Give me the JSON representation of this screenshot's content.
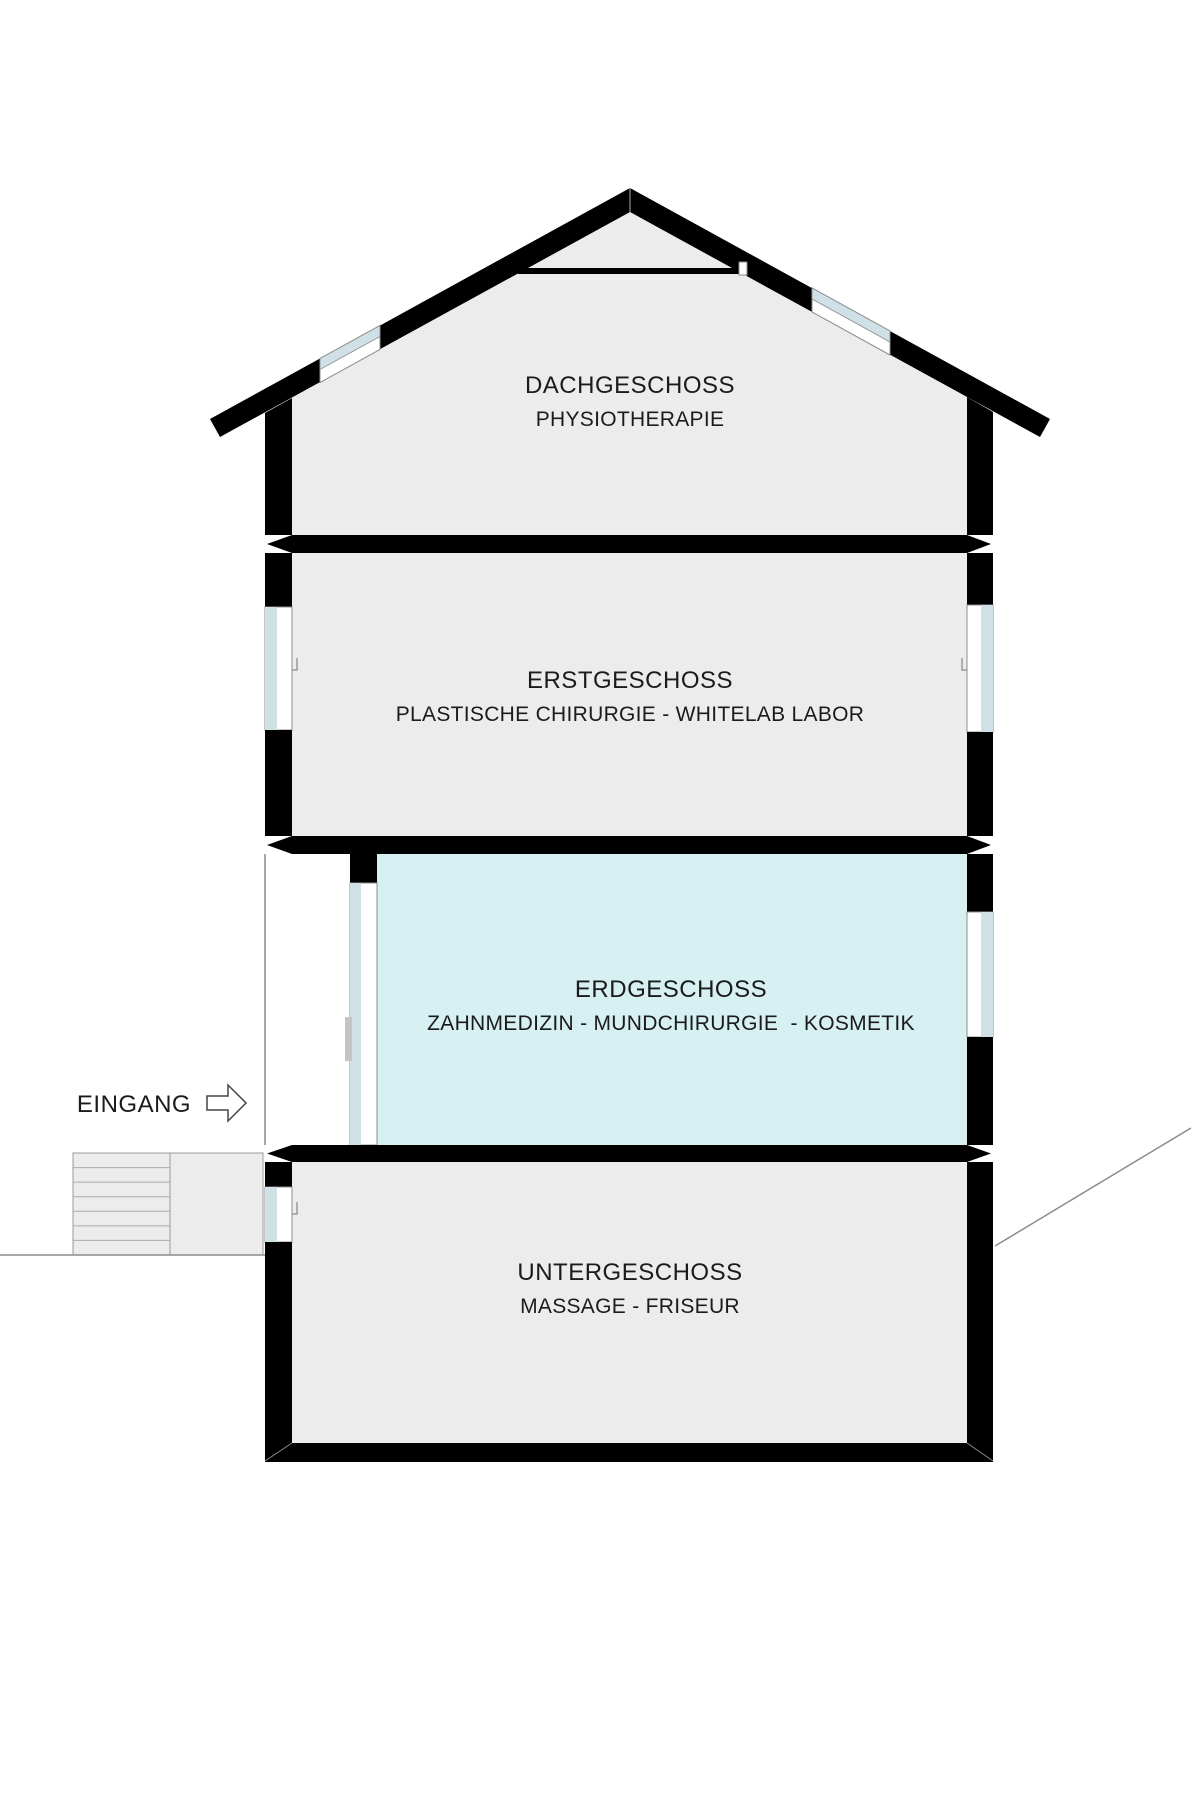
{
  "diagram": {
    "type": "building-cross-section",
    "floors": [
      {
        "id": "dachgeschoss",
        "title": "DACHGESCHOSS",
        "subtitle": "PHYSIOTHERAPIE"
      },
      {
        "id": "erstgeschoss",
        "title": "ERSTGESCHOSS",
        "subtitle": "PLASTISCHE CHIRURGIE - WHITELAB LABOR"
      },
      {
        "id": "erdgeschoss",
        "title": "ERDGESCHOSS",
        "subtitle": "ZAHNMEDIZIN - MUNDCHIRURGIE  - KOSMETIK",
        "highlighted": true
      },
      {
        "id": "untergeschoss",
        "title": "UNTERGESCHOSS",
        "subtitle": "MASSAGE - FRISEUR"
      }
    ],
    "entrance_label": "EINGANG",
    "colors": {
      "wall": "#000000",
      "interior": "#ececec",
      "highlight_room": "#d7f0f2",
      "glazing_blue": "#d0e0e7",
      "thin_line": "#8c8c8c",
      "stair_line": "#ababab",
      "handle": "#c4c4c4"
    }
  }
}
